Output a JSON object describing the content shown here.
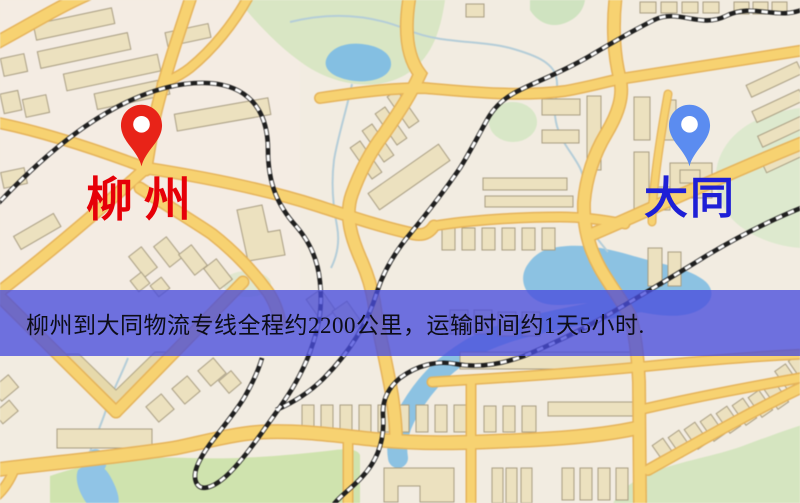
{
  "map": {
    "markers": [
      {
        "id": "liuzhou",
        "label": "柳州",
        "pin_color": "#e82318",
        "label_color": "#e60008"
      },
      {
        "id": "datong",
        "label": "大同",
        "pin_color": "#5b8cf0",
        "label_color": "#1e1fd6"
      }
    ],
    "banner": {
      "text": "柳州到大同物流专线全程约2200公里，运输时间约1天5小时.",
      "bg_color": "rgba(73,77,221,0.78)",
      "text_color": "#0d0d18"
    },
    "palette": {
      "background": "#f2ece1",
      "road_major": "#f7d271",
      "road_casing": "#e5b35a",
      "park_green": "#cfe3ae",
      "water_blue": "#8cc2e2",
      "railway": "#1f1f1f"
    }
  }
}
